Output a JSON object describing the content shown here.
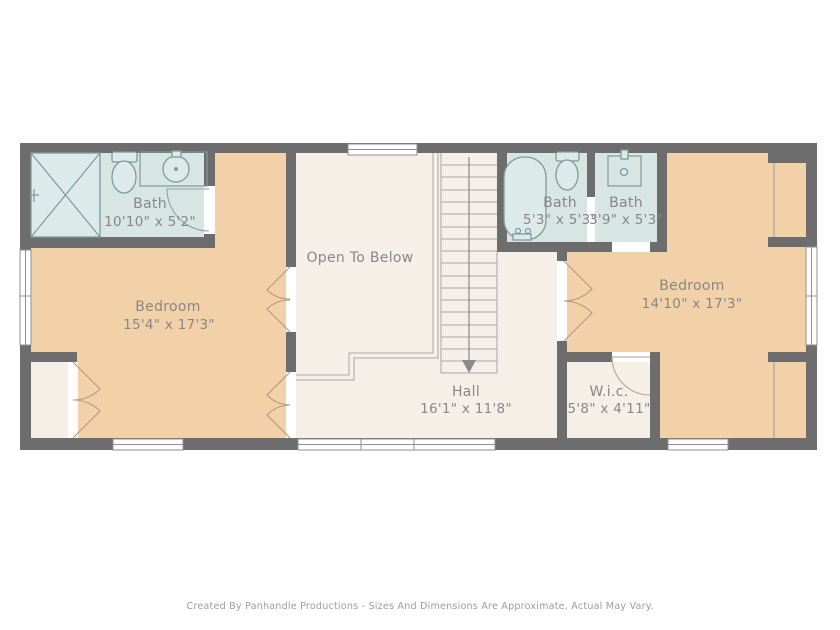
{
  "plan": {
    "rooms": {
      "bath_left": {
        "label": "Bath",
        "dims": "10'10\" x 5'2\""
      },
      "bedroom_left": {
        "label": "Bedroom",
        "dims": "15'4\" x 17'3\""
      },
      "open_to_below": {
        "label": "Open To Below"
      },
      "bath_middle": {
        "label": "Bath",
        "dims": "5'3\" x 5'3\""
      },
      "bath_small": {
        "label": "Bath",
        "dims": "3'9\" x 5'3\""
      },
      "bedroom_right": {
        "label": "Bedroom",
        "dims": "14'10\" x 17'3\""
      },
      "hall": {
        "label": "Hall",
        "dims": "16'1\" x 11'8\""
      },
      "wic": {
        "label": "W.i.c.",
        "dims": "5'8\" x 4'11\""
      }
    },
    "colors": {
      "wall": "#6d6d6d",
      "bathroom_floor": "#d7e5e3",
      "bedroom_floor": "#f2d1a8",
      "hall_floor": "#f6efe8",
      "fixture_stroke": "#7e9a99",
      "label_text": "#878787",
      "footer_text": "#9c9c9c"
    },
    "footer": "Created By Panhandle Productions - Sizes And Dimensions Are Approximate, Actual May Vary."
  }
}
